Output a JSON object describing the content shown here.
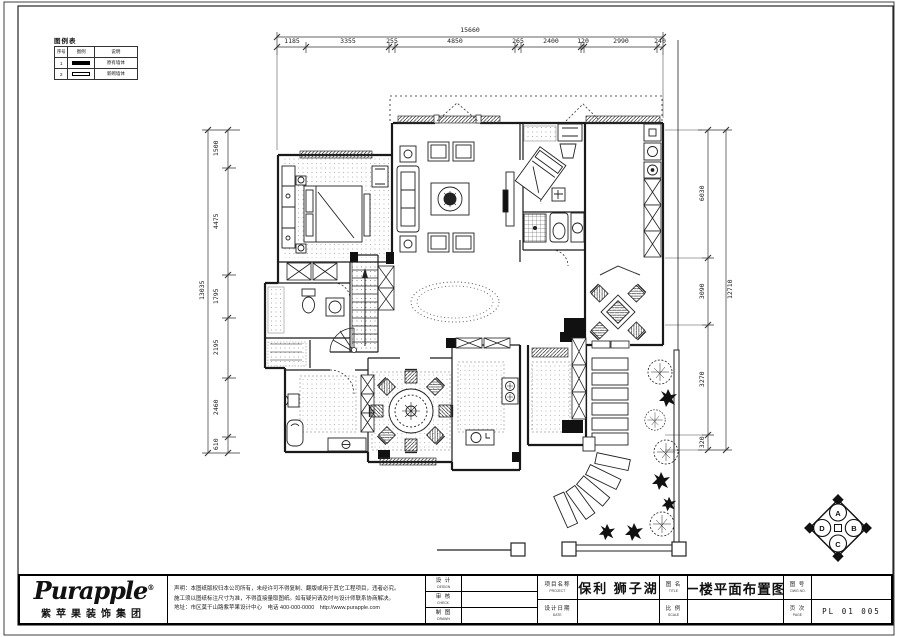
{
  "legend": {
    "title": "图例表",
    "headers": [
      "序号",
      "图例",
      "说明"
    ],
    "rows": [
      {
        "no": "1",
        "desc": "原有墙体"
      },
      {
        "no": "2",
        "desc": "新砌墙体"
      }
    ]
  },
  "dimensions": {
    "top": {
      "total": "15660",
      "segments": [
        "1185",
        "3355",
        "255",
        "4850",
        "265",
        "2400",
        "120",
        "2990",
        "240"
      ]
    },
    "left": {
      "total": "13035",
      "segments": [
        "1500",
        "4475",
        "1795",
        "2195",
        "2460",
        "610"
      ]
    },
    "right": {
      "total": "12710",
      "segments": [
        "6030",
        "3090",
        "3270",
        "320"
      ]
    }
  },
  "titleblock": {
    "logo": "Purapple",
    "logo_reg": "®",
    "logo_cn": "紫苹果装饰集团",
    "disclaimer1": "声明：本图纸版权归本公司所有，未经许可不得复制、翻版或用于其它工程项目，违者必究。",
    "disclaimer2": "施工须以图纸标注尺寸为准，不得直接量取图纸。如有疑问请及时与设计师联系协商解决。",
    "disclaimer3": "地址：市区莫干山路紫苹果设计中心　电话 400-000-0000　http://www.purapple.com",
    "col1": [
      {
        "cn": "设 计",
        "en": "DESIGN"
      },
      {
        "cn": "审 核",
        "en": "CHECK"
      },
      {
        "cn": "制 图",
        "en": "DRAWN"
      }
    ],
    "col3": [
      {
        "cn": "项目名称",
        "en": "PROJECT"
      },
      {
        "cn": "设计日期",
        "en": "DATE"
      }
    ],
    "project_name": "保利 狮子湖",
    "col5": [
      {
        "cn": "图 名",
        "en": "TITLE"
      },
      {
        "cn": "比 例",
        "en": "SCALE"
      }
    ],
    "drawing_title": "一楼平面布置图",
    "col7": [
      {
        "cn": "图 号",
        "en": "DWG NO."
      },
      {
        "cn": "页 次",
        "en": "PAGE"
      }
    ],
    "sheet_no": "PL 01 005"
  },
  "compass": {
    "a": "A",
    "b": "B",
    "c": "C",
    "d": "D"
  }
}
